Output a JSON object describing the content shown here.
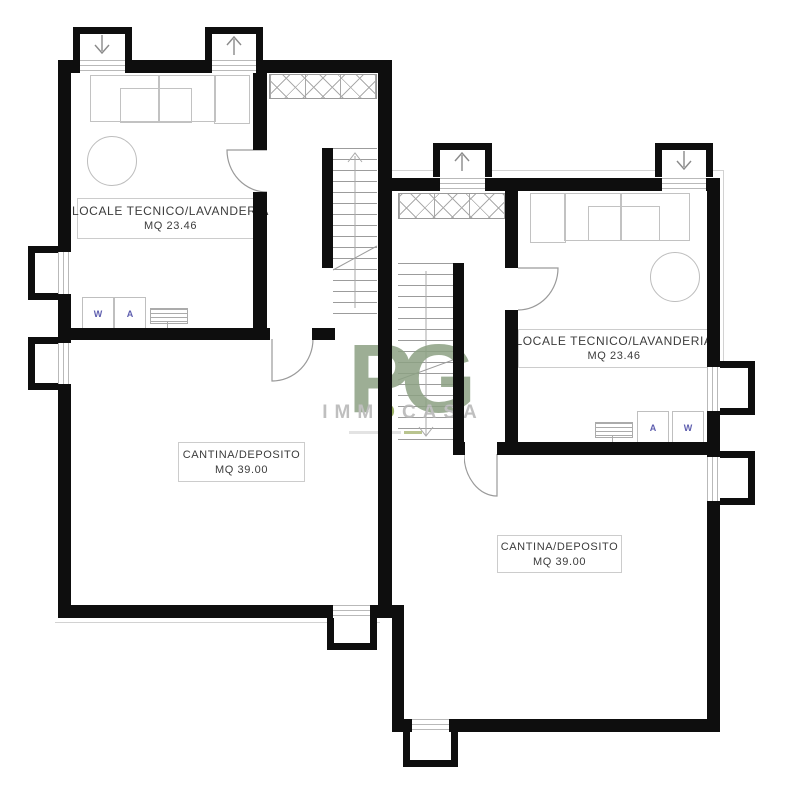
{
  "watermark": {
    "logo": "PG",
    "brand_prefix": "IMM",
    "brand_accent": "O",
    "brand_suffix": "CASA"
  },
  "units": [
    {
      "side": "left",
      "technical_room": {
        "name": "LOCALE TECNICO/LAVANDERIA",
        "area": "MQ 23.46"
      },
      "cellar": {
        "name": "CANTINA/DEPOSITO",
        "area": "MQ 39.00"
      },
      "washer_label": "W",
      "dryer_label": "A"
    },
    {
      "side": "right",
      "technical_room": {
        "name": "LOCALE TECNICO/LAVANDERIA",
        "area": "MQ 23.46"
      },
      "cellar": {
        "name": "CANTINA/DEPOSITO",
        "area": "MQ 39.00"
      },
      "washer_label": "W",
      "dryer_label": "A"
    }
  ],
  "colors": {
    "wall": "#0e0e0e",
    "watermark_green": "#8ca183",
    "watermark_accent_green": "#8fa94e",
    "brand_gray": "#b5b5b5",
    "appliance_letter_blue": "#5d5dae"
  }
}
